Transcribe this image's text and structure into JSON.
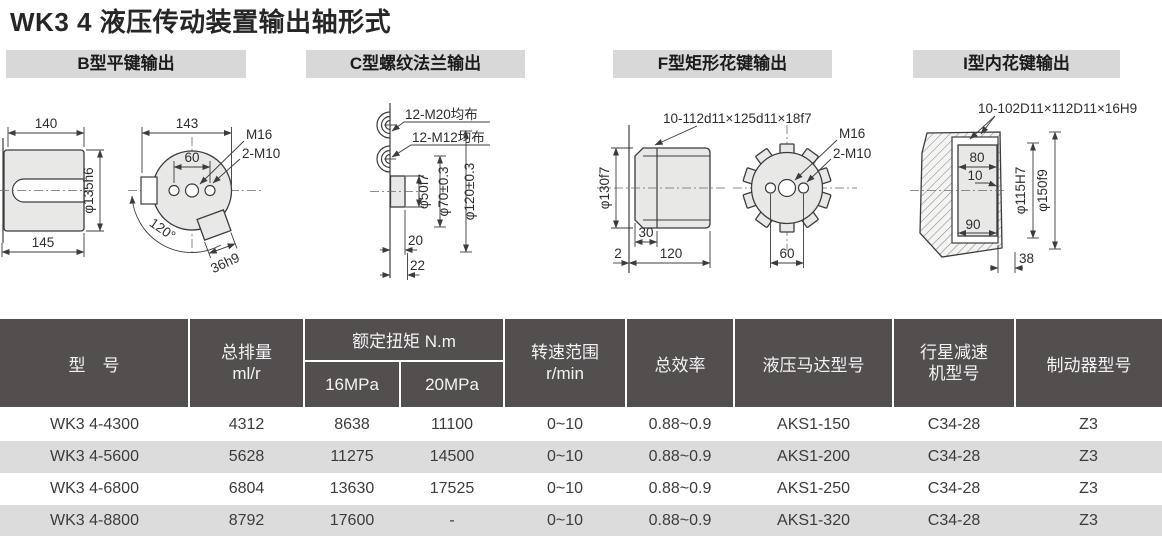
{
  "page": {
    "title": "WK3 4 液压传动装置输出轴形式"
  },
  "sections": {
    "b": {
      "label": "B型平键输出"
    },
    "c": {
      "label": "C型螺纹法兰输出"
    },
    "f": {
      "label": "F型矩形花键输出"
    },
    "i": {
      "label": "I型内花键输出"
    }
  },
  "diagrams": {
    "b": {
      "dim_140": "140",
      "dim_145": "145",
      "dim_dia": "φ135h6",
      "dim_143": "143",
      "dim_60": "60",
      "m16": "M16",
      "m10": "2-M10",
      "angle": "120°",
      "key": "36h9"
    },
    "c": {
      "m20": "12-M20均布",
      "m12": "12-M12均布",
      "dia50": "φ50f7",
      "dia70": "φ70±0.3",
      "dia120": "φ120±0.3",
      "w20": "20",
      "w22": "22"
    },
    "f": {
      "spline": "10-112d11×125d11×18f7",
      "m16": "M16",
      "m10": "2-M10",
      "dia": "φ130f7",
      "d30": "30",
      "d2": "2",
      "d120": "120",
      "d60": "60"
    },
    "i": {
      "spline": "10-102D11×112D11×16H9",
      "d80": "80",
      "d10": "10",
      "d90": "90",
      "dia115": "φ115H7",
      "dia150": "φ150f9",
      "d38": "38"
    }
  },
  "table": {
    "columns": {
      "model": "型　号",
      "disp1": "总排量",
      "disp2": "ml/r",
      "torque": "额定扭矩 N.m",
      "t16": "16MPa",
      "t20": "20MPa",
      "speed1": "转速范围",
      "speed2": "r/min",
      "eff": "总效率",
      "motor": "液压马达型号",
      "red1": "行星减速",
      "red2": "机型号",
      "brake": "制动器型号"
    },
    "rows": [
      [
        "WK3 4-4300",
        "4312",
        "8638",
        "11100",
        "0~10",
        "0.88~0.9",
        "AKS1-150",
        "C34-28",
        "Z3"
      ],
      [
        "WK3 4-5600",
        "5628",
        "11275",
        "14500",
        "0~10",
        "0.88~0.9",
        "AKS1-200",
        "C34-28",
        "Z3"
      ],
      [
        "WK3 4-6800",
        "6804",
        "13630",
        "17525",
        "0~10",
        "0.88~0.9",
        "AKS1-250",
        "C34-28",
        "Z3"
      ],
      [
        "WK3 4-8800",
        "8792",
        "17600",
        "-",
        "0~10",
        "0.88~0.9",
        "AKS1-320",
        "C34-28",
        "Z3"
      ]
    ]
  },
  "colors": {
    "table_header_bg": "#534f4f",
    "row_stripe": "#dcdcdc",
    "section_bar_bg": "#d8d8d8"
  }
}
